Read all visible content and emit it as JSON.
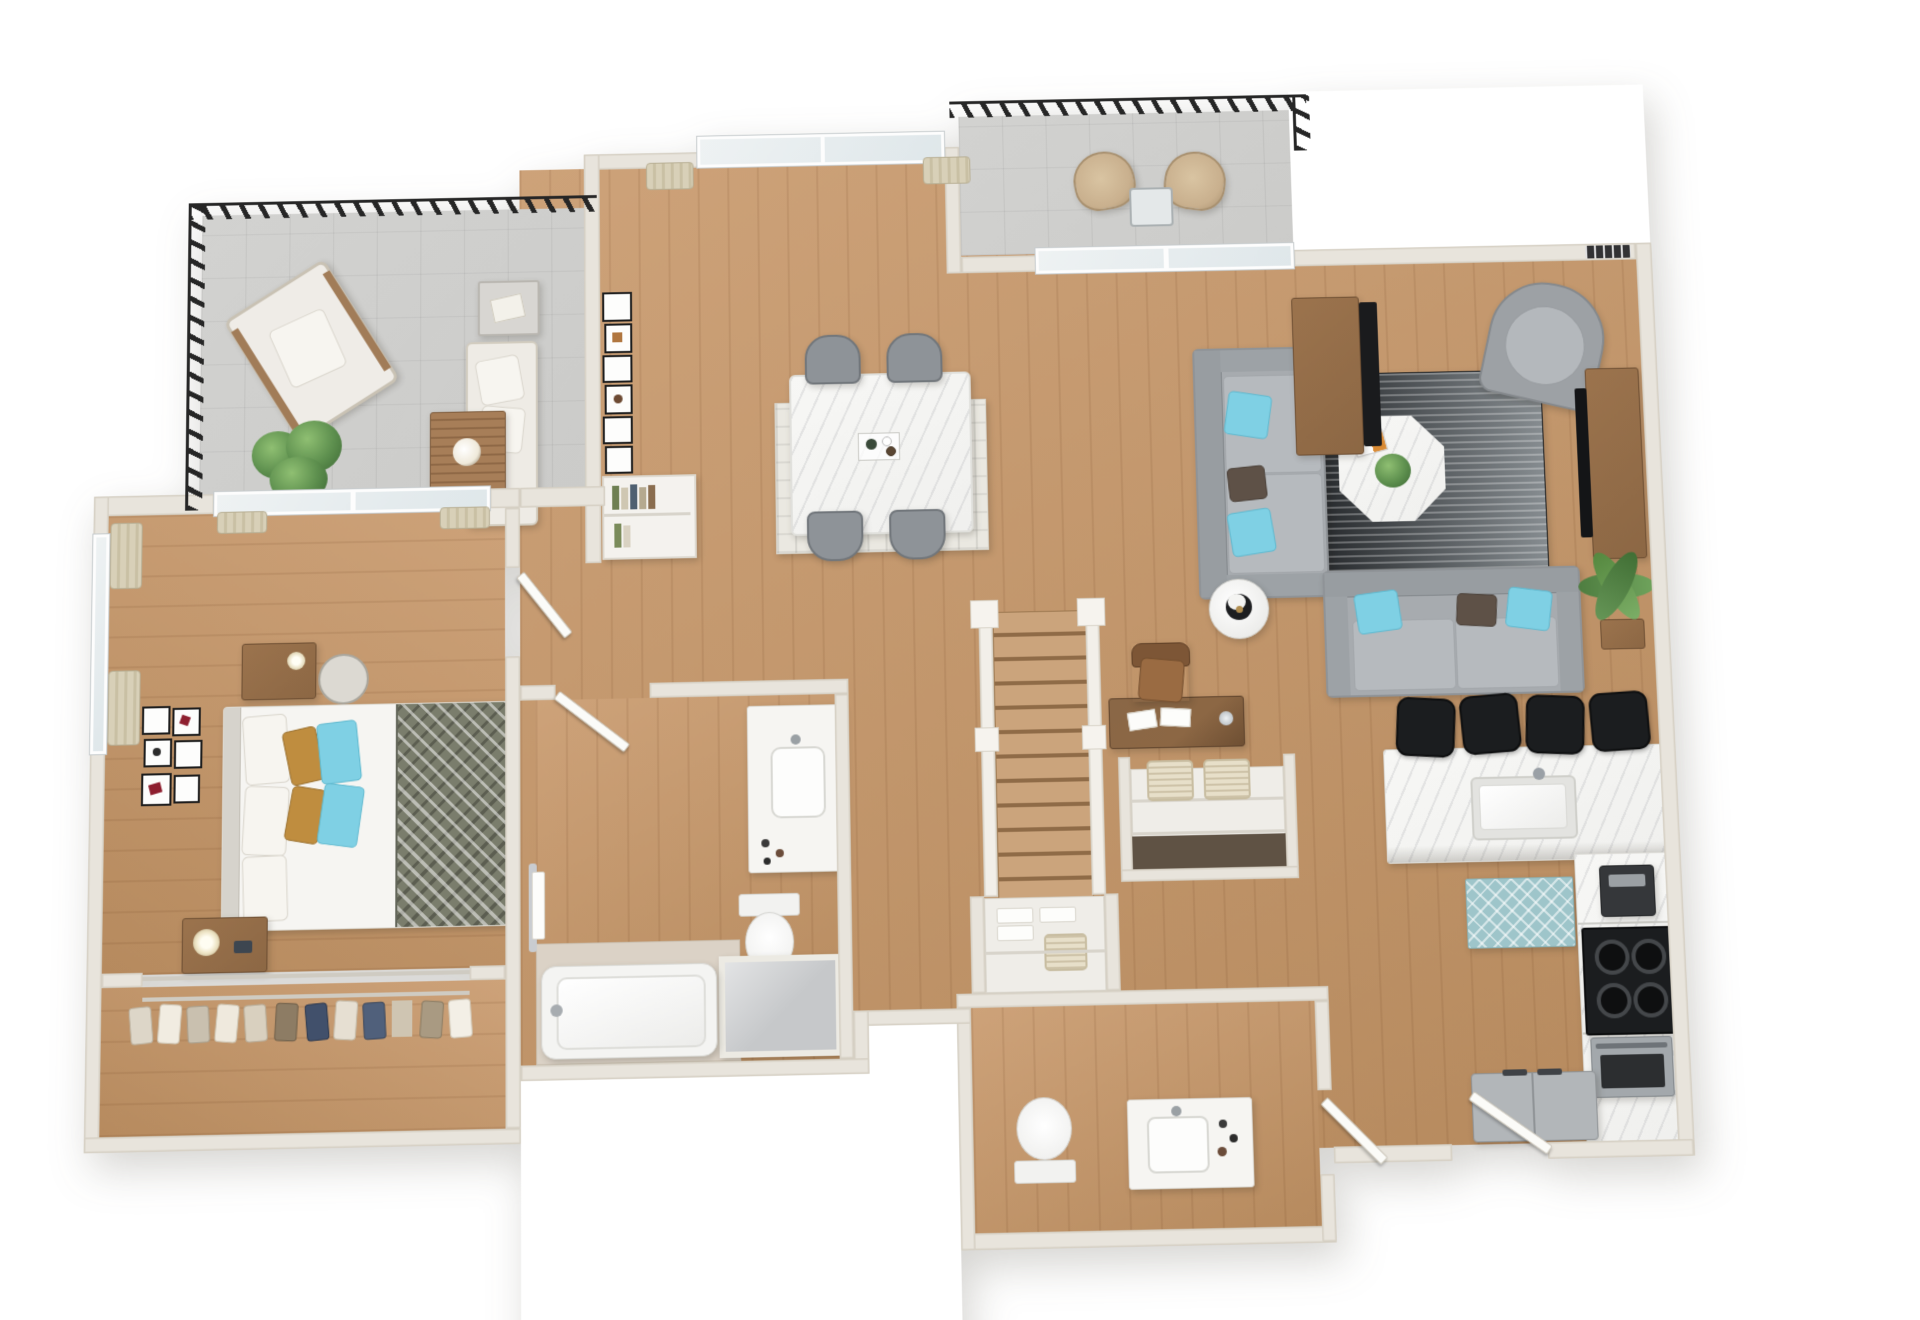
{
  "meta": {
    "type": "3d-floor-plan-render",
    "view": "top-down",
    "width_px": 1920,
    "height_px": 1320,
    "visible_text": "none"
  },
  "palette": {
    "wall": "#e8e4dc",
    "wall_edge": "#d5cfc3",
    "wood_a": "#cda279",
    "wood_b": "#b68a5e",
    "concrete": "#cbcbc9",
    "rail": "#262626",
    "marble": "#f0f0ee",
    "sofa": "#a7abaf",
    "cushion": "#b6babe",
    "teal": "#7fd0e4",
    "brown_pillow": "#5e5147",
    "mustard": "#bf8d3f",
    "rug_dark_a": "#202326",
    "rug_dark_b": "#868c90",
    "rug_teal": "#9ec5ca",
    "rug_dining": "#eae8e1",
    "wood_furn": "#8c6744",
    "white_furn": "#f6f5f2",
    "gray_appliance": "#b2b6b9",
    "black_appliance": "#1b1d1f",
    "steel": "#a3a8ac",
    "plant": "#5d8f4e",
    "plant_dark": "#3f6b36",
    "curtain": "#d8d0b8",
    "blanket": "#7a7d6c",
    "tile": "#dbd2c6",
    "basket": "#e7dfc9",
    "closet_shelf": "#efede8",
    "frame_red": "#8e1f2f"
  },
  "rooms": [
    {
      "id": "balcony-left",
      "name": "terrace balcony",
      "floor": "concrete",
      "furniture": [
        "outdoor armchair",
        "outdoor sofa",
        "slatted coffee table with flowers",
        "side table with book",
        "potted plant",
        "metal railing"
      ]
    },
    {
      "id": "dining-area",
      "name": "dining area",
      "floor": "hardwood",
      "furniture": [
        "marble dining table",
        "4 gray dining chairs",
        "patterned area rug",
        "gallery wall frames",
        "bookshelf with books",
        "window with curtains"
      ]
    },
    {
      "id": "living-room",
      "name": "living room",
      "floor": "hardwood",
      "furniture": [
        "gray sofa with teal pillows",
        "gray loveseat with teal pillows",
        "gray barrel accent chair",
        "octagonal marble coffee table with plant and magazine",
        "black striped rug",
        "media console",
        "tv",
        "sideboard",
        "floor plant",
        "round side table with lamp",
        "sliding balcony door"
      ]
    },
    {
      "id": "balcony-right",
      "name": "upper balcony",
      "floor": "concrete",
      "furniture": [
        "2 wicker chairs",
        "cafe table",
        "metal railing",
        "wall vent"
      ]
    },
    {
      "id": "bedroom",
      "name": "bedroom",
      "floor": "hardwood",
      "furniture": [
        "bed with chevron blanket and mustard and teal pillows",
        "nightstand with lamp",
        "desk with lamp",
        "wire chair",
        "gallery wall frames",
        "curtained windows",
        "sliding balcony door"
      ]
    },
    {
      "id": "closet",
      "name": "wardrobe closet",
      "floor": "hardwood",
      "furniture": [
        "hanging clothes on hangers"
      ]
    },
    {
      "id": "bathroom-ensuite",
      "name": "ensuite bathroom",
      "floor": "hardwood and tile",
      "furniture": [
        "vanity with sink",
        "toilet",
        "bathtub",
        "shower",
        "towel bar"
      ]
    },
    {
      "id": "hallway",
      "name": "hallway",
      "floor": "hardwood",
      "furniture": [
        "interior doors"
      ]
    },
    {
      "id": "stairs",
      "name": "staircase",
      "detail": "straight run, 12 treads, white stringers and newel posts"
    },
    {
      "id": "storage",
      "name": "storage closets",
      "furniture": [
        "open shelving",
        "2 woven baskets",
        "linen shelves with towels",
        "basket"
      ]
    },
    {
      "id": "bathroom-2",
      "name": "second bathroom",
      "floor": "hardwood",
      "furniture": [
        "vanity with sink",
        "toilet"
      ]
    },
    {
      "id": "kitchen",
      "name": "kitchen",
      "floor": "hardwood",
      "furniture": [
        "marble breakfast bar island with sink",
        "4 black bar stools",
        "gray cabinet run",
        "coffee maker",
        "black gas range",
        "stainless oven",
        "refrigerator",
        "teal diamond rug"
      ]
    },
    {
      "id": "entry",
      "name": "entry",
      "furniture": [
        "entry door"
      ]
    }
  ],
  "counts": {
    "bar_stools": 4,
    "dining_chairs": 4,
    "stair_treads": 12,
    "sofas": 2,
    "balconies": 2,
    "bathrooms": 2
  }
}
